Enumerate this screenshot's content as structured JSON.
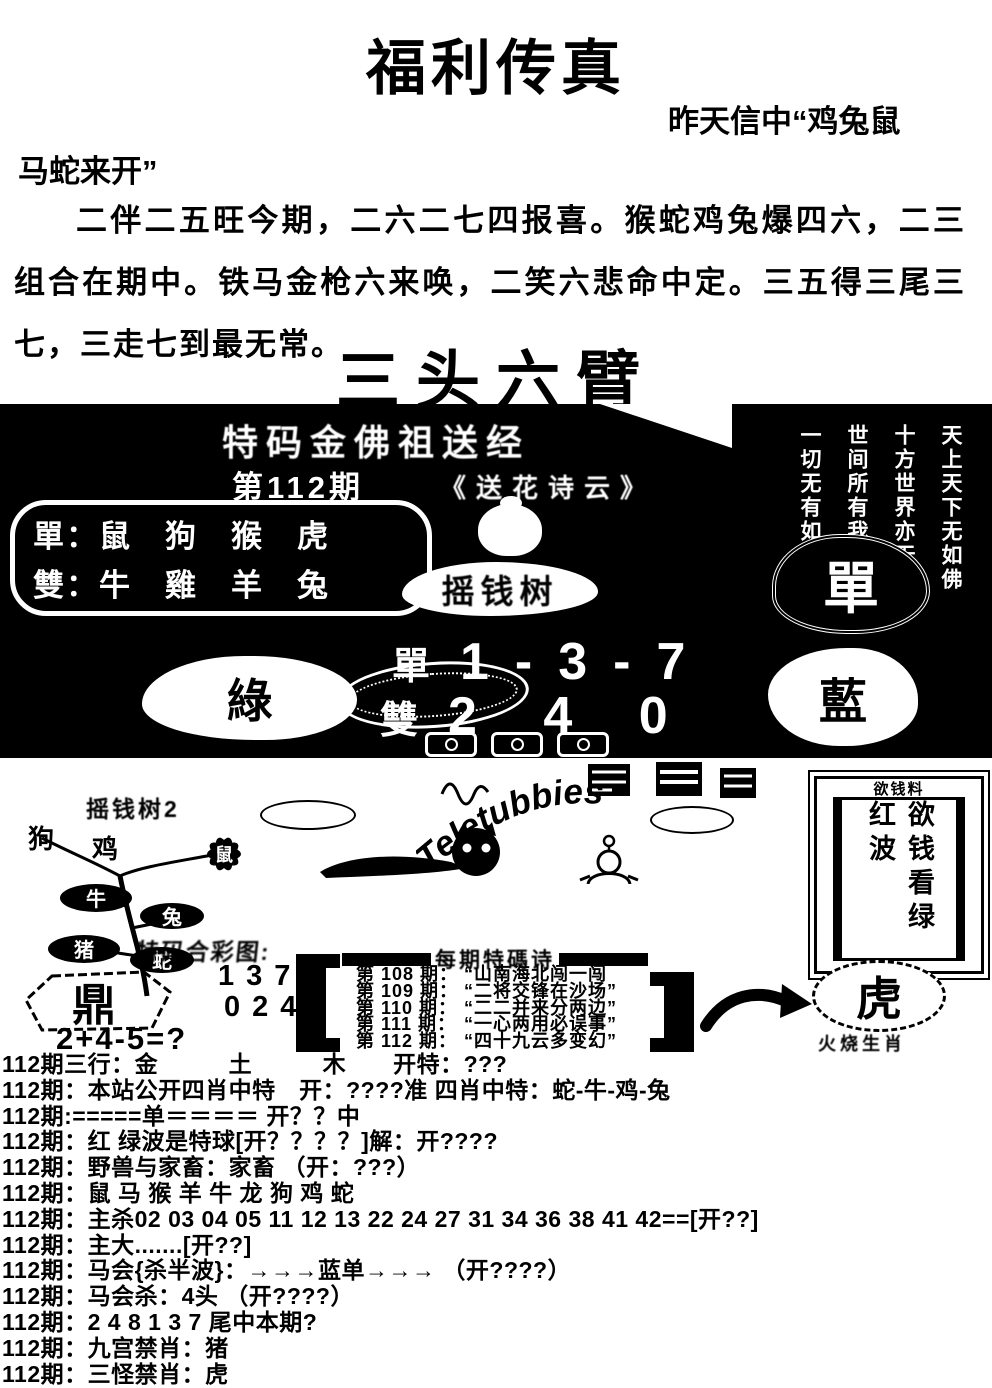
{
  "page": {
    "background": "#ffffff",
    "ink": "#000000"
  },
  "header": {
    "title": "福利传真",
    "note_line1": "昨天信中“鸡兔鼠",
    "note_line2": "马蛇来开”"
  },
  "poem": "二伴二五旺今期，二六二七四报喜。猴蛇鸡兔爆四六，二三组合在期中。铁马金枪六来唤，二笑六悲命中定。三五得三尾三七，三走七到最无常。",
  "main_title": "三头六臂",
  "banner": {
    "top_title": "特码金佛祖送经",
    "issue": "第112期",
    "subtitle": "《送花诗云》",
    "dan_row": "單：鼠　狗　猴　虎",
    "shuang_row": "雙：牛　雞　羊　兔",
    "tree_label": "摇钱树",
    "dan_label": "單",
    "dan_numbers": "1-3-7",
    "shuang_label": "雙",
    "shuang_numbers": "2 4 0",
    "big_dan": "單",
    "green": "綠",
    "blue": "藍",
    "verses": [
      "一切无有如佛者",
      "世间所有我尽见",
      "十方世界亦无比",
      "天上天下无如佛"
    ]
  },
  "middle": {
    "tree2_title": "摇钱树2",
    "tree_animals": [
      "狗",
      "鸡",
      "鼠",
      "牛",
      "兔",
      "猪",
      "蛇"
    ],
    "teletubbies_text": "Teletubbies",
    "smudge_caption": "特码合彩图:",
    "ding": "鼎",
    "numbers_top": "137",
    "numbers_bottom": "024",
    "equation": "2+4-5=?",
    "periods_title": "每期特碼诗",
    "periods": [
      {
        "num": "第 108 期：",
        "text": "“山南海北闯一闯"
      },
      {
        "num": "第 109 期：",
        "text": "“二将交锋在沙场”"
      },
      {
        "num": "第 110 期：",
        "text": "“二二并来分两边”"
      },
      {
        "num": "第 111 期：",
        "text": "“一心两用必误事”"
      },
      {
        "num": "第 112 期：",
        "text": "“四十九云多变幻”"
      }
    ],
    "money_box": {
      "header": "欲钱料",
      "text": "欲钱看绿红波"
    },
    "tiger": "虎",
    "tiger_caption": "火烧生肖"
  },
  "bottom": {
    "lines": [
      "112期三行：金　　　土　　　木　　开特：???",
      "112期：本站公开四肖中特　开：????准 四肖中特：蛇-牛-鸡-兔",
      "112期:=====单＝＝＝＝ 开？？中",
      "112期：红 绿波是特球[开？？？？]解：开????",
      "112期：野兽与家畜：家畜 （开：???）",
      "112期：鼠 马 猴 羊 牛 龙 狗 鸡 蛇",
      "112期：主杀02 03 04 05 11 12 13 22 24 27 31 34 36 38 41 42==[开??]",
      "112期：主大.......[开??]",
      "112期：马会{杀半波}：→→→蓝单→→→ （开????）",
      "112期：马会杀：4头 （开????）",
      "112期：2 4 8 1 3 7 尾中本期?",
      "112期：九宫禁肖：猪",
      "112期：三怪禁肖：虎"
    ]
  }
}
